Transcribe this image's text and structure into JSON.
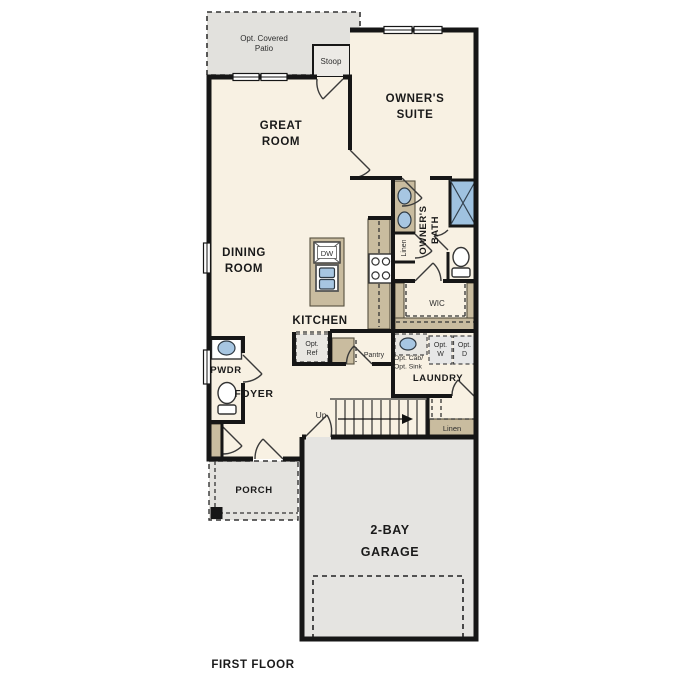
{
  "title": "FIRST FLOOR",
  "rooms": {
    "patio": [
      "Opt. Covered",
      "Patio"
    ],
    "stoop": "Stoop",
    "owners_suite": [
      "OWNER'S",
      "SUITE"
    ],
    "great_room": [
      "GREAT",
      "ROOM"
    ],
    "dining_room": [
      "DINING",
      "ROOM"
    ],
    "kitchen": "KITCHEN",
    "owners_bath": [
      "OWNER'S",
      "BATH"
    ],
    "wic": "WIC",
    "pwdr": "PWDR",
    "foyer": "FOYER",
    "laundry": "LAUNDRY",
    "porch": "PORCH",
    "garage": [
      "2-BAY",
      "GARAGE"
    ]
  },
  "fixtures": {
    "dishwasher": "DW",
    "opt_ref": [
      "Opt.",
      "Ref"
    ],
    "pantry": "Pantry",
    "opt_cab_sink": [
      "Opt. Cab/",
      "Opt. Sink"
    ],
    "opt_washer": [
      "Opt.",
      "W"
    ],
    "opt_dryer": [
      "Opt.",
      "D"
    ],
    "linen_bath": "Linen",
    "linen_stairs": "Linen",
    "stairs_up": "Up"
  },
  "colors": {
    "floor": "#F8F1E3",
    "hardscape": "#E4E3DF",
    "patio": "#E2E1DD",
    "cabinet": "#C9BC9F",
    "fixture_blue": "#A7C6E2",
    "wall": "#161616"
  }
}
